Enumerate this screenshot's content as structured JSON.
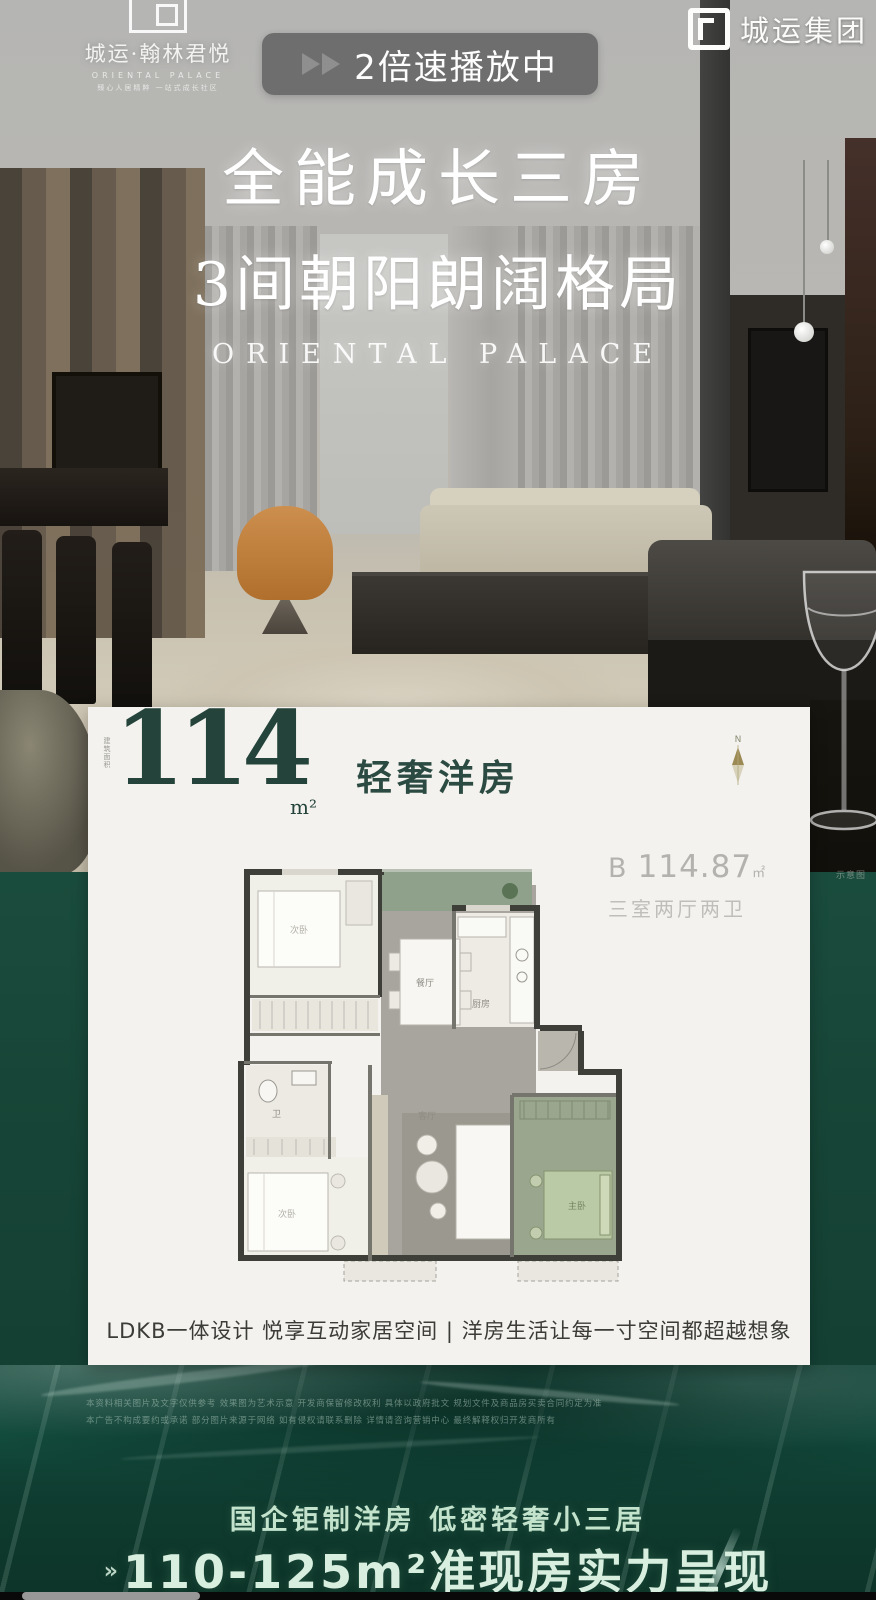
{
  "overlay": {
    "speed_text": "2倍速播放中",
    "video_progress_percent": 20
  },
  "brand": {
    "project_logo_title": "城运·翰林君悦",
    "project_logo_subtitle": "ORIENTAL PALACE",
    "project_logo_tagline": "臻心人居精粹 一站式成长社区",
    "group_logo_text": "城运集团"
  },
  "hero": {
    "line1": "全能成长三房",
    "line2": "3间朝阳朗阔格局",
    "english": "ORIENTAL PALACE"
  },
  "card": {
    "area_value": "114",
    "area_unit": "m²",
    "area_side_label": "建筑面积",
    "product_type": "轻奢洋房",
    "compass_label": "N",
    "unit": {
      "code": "B",
      "area": "114.87",
      "area_unit": "㎡",
      "layout": "三室两厅两卫"
    },
    "floorplan": {
      "labels": {
        "bed_top": "次卧",
        "dining": "餐厅",
        "kitchen": "厨房",
        "bath": "卫",
        "bed_left": "次卧",
        "living": "客厅",
        "master": "主卧"
      }
    },
    "tagline": "LDKB一体设计  悦享互动家居空间  |  洋房生活让每一寸空间都超越想象",
    "schematic_note": "示意图"
  },
  "footer": {
    "disclaimer_line1": "本资料相关图片及文字仅供参考 效果图为艺术示意 开发商保留修改权利 具体以政府批文 规划文件及商品房买卖合同约定为准",
    "disclaimer_line2": "本广告不构成要约或承诺 部分图片来源于网络 如有侵权请联系删除 详情请咨询营销中心 最终解释权归开发商所有",
    "slogan_small": "国企钜制洋房  低密轻奢小三居",
    "slogan_large_prefix": "»",
    "slogan_large": "110-125m²准现房实力呈现"
  },
  "colors": {
    "green_bg": "#17473a",
    "card_bg": "#f3f2ee",
    "accent_teal": "#24443b",
    "slogan_green": "#d8efe0",
    "orange_chair": "#c98a4b"
  }
}
